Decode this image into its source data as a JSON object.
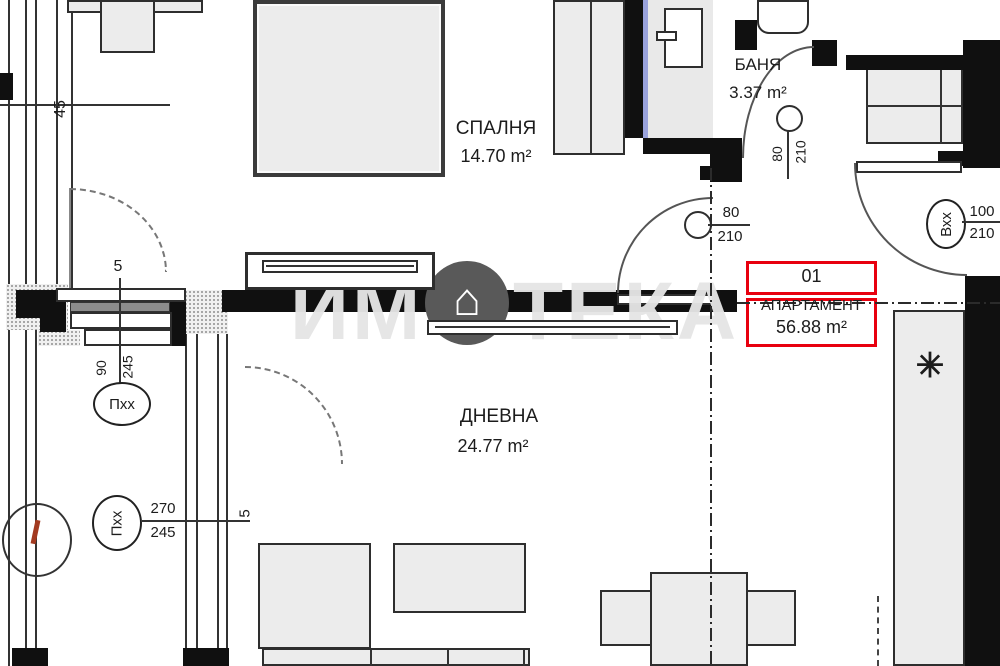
{
  "watermark": {
    "left": "ИМ",
    "right": "ТЕКА",
    "full": "ИМОТЕКА",
    "house": "⌂"
  },
  "rooms": {
    "bedroom": {
      "name": "СПАЛНЯ",
      "area": "14.70 m²"
    },
    "bathroom": {
      "name": "БАНЯ",
      "area": "3.37 m²"
    },
    "living": {
      "name": "ДНЕВНА",
      "area": "24.77 m²"
    }
  },
  "tag": {
    "number": "01",
    "label": "АПАРТАМЕНТ",
    "area": "56.88 m²",
    "border_color": "#e8000f"
  },
  "doors": {
    "bedroom": {
      "w": "80",
      "h": "210"
    },
    "bathroom": {
      "w": "80",
      "h": "210"
    },
    "entry": {
      "code": "Вхх",
      "w": "100",
      "h": "210"
    }
  },
  "windows": {
    "upper": {
      "code": "Пхх",
      "w": "90",
      "h": "245"
    },
    "lower": {
      "code": "Пхх",
      "w": "270",
      "h": "245",
      "mark": "5"
    }
  },
  "dims": {
    "left": "45",
    "window": "5"
  },
  "icons": {
    "freezer": "✳"
  },
  "colors": {
    "glazing": "#9aa3dc",
    "tag_border": "#e8000f",
    "watermark": "#e5e5e5"
  }
}
